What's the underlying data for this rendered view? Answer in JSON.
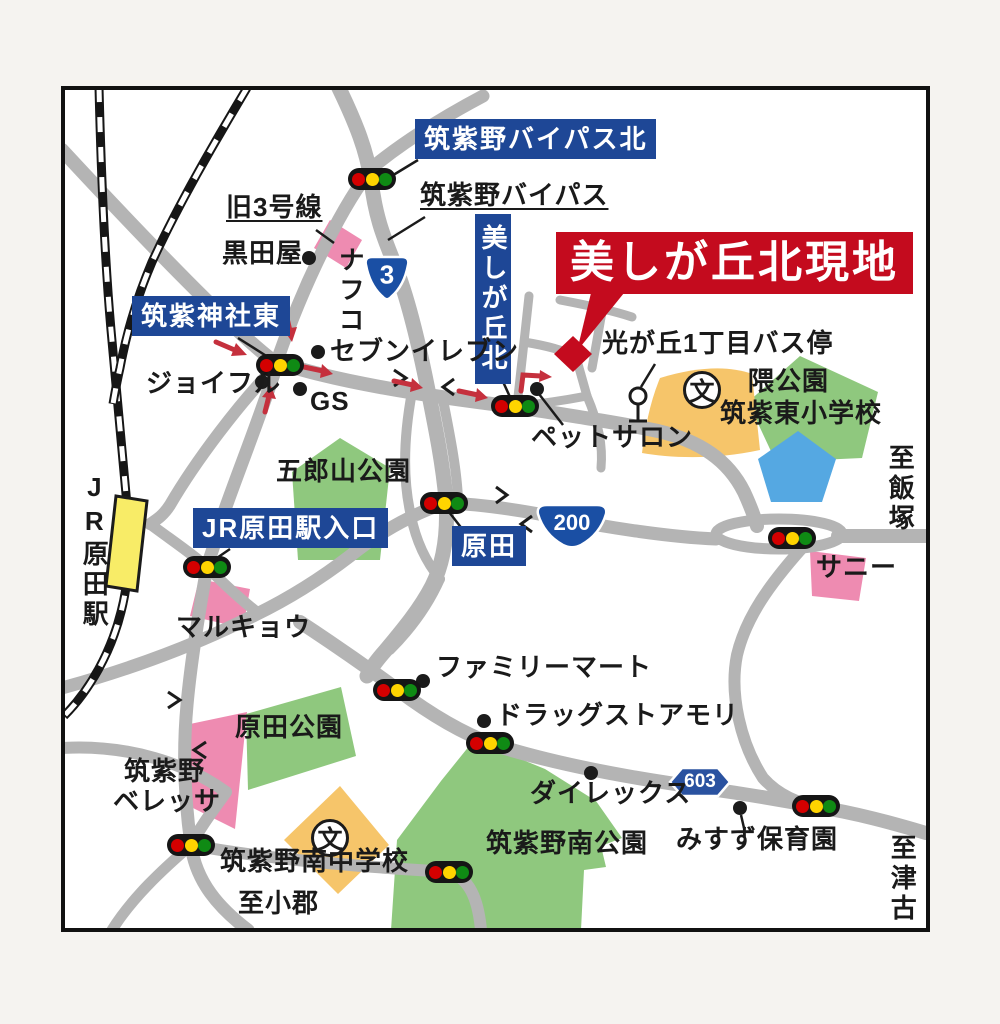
{
  "map": {
    "site_label": "美しが丘北現地",
    "blue_boxes": {
      "bypass_north": "筑紫野バイパス北",
      "jinja_east": "筑紫神社東",
      "utsukushigaoka_kita": "美しが丘北",
      "jr_harada_entrance": "JR原田駅入口",
      "harada": "原田"
    },
    "roads": {
      "old_route3": "旧3号線",
      "bypass": "筑紫野バイパス"
    },
    "route_numbers": {
      "national_3": "3",
      "national_200": "200",
      "prefectural_603": "603"
    },
    "landmarks": {
      "kurodaya": "黒田屋",
      "nafco": "ナフコ",
      "seven_eleven": "セブンイレブン",
      "joyful": "ジョイフル",
      "gas_station": "GS",
      "pet_salon": "ペットサロン",
      "bus_stop": "光が丘1丁目バス停",
      "kuma_park": "隈公園",
      "chikushi_higashi_es": "筑紫東小学校",
      "gorouyama_park": "五郎山公園",
      "jr_harada_station": "JR原田駅",
      "marukyo": "マルキョウ",
      "sunny": "サニー",
      "family_mart": "ファミリーマート",
      "drug_store_mori": "ドラッグストアモリ",
      "direx": "ダイレックス",
      "misuzu_nursery": "みすず保育園",
      "harada_park": "原田公園",
      "veressa_line1": "筑紫野",
      "veressa_line2": "ベレッサ",
      "minami_jhs": "筑紫野南中学校",
      "minami_park": "筑紫野南公園",
      "school_symbol": "文"
    },
    "directions": {
      "to_iizuka": "至飯塚",
      "to_ogori": "至小郡",
      "to_tsuko": "至津古"
    },
    "colors": {
      "road_gray": "#b4b4b4",
      "label_blue": "#1e4796",
      "site_red": "#c40b1e",
      "park_green": "#8fc87e",
      "facility_orange": "#f6c56a",
      "store_pink": "#ee8bb1",
      "pond_blue": "#55a8e2",
      "station_yellow": "#f8ec67",
      "signal_red": "#d40000",
      "signal_yellow": "#ffd400",
      "signal_green": "#0f8a14",
      "arrow_red": "#c5303d"
    }
  }
}
